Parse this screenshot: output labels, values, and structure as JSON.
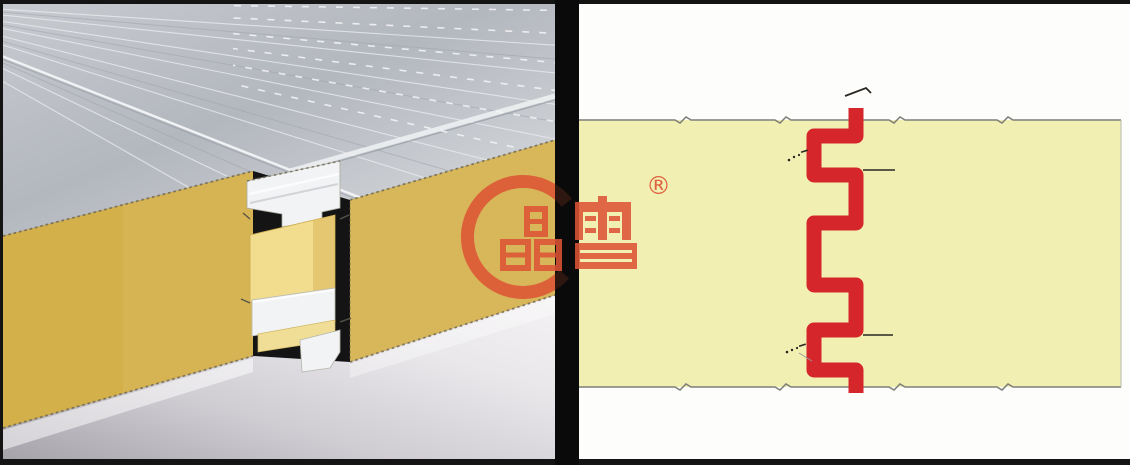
{
  "frame": {
    "border_color": "#141414"
  },
  "divider": {
    "color": "#0a0a0a"
  },
  "photo": {
    "alt": "3D rendering of two insulated sandwich panels locked together: grey ribbed metal roof facing on top, yellow foam core cross-section facing the viewer, white metal tongue-and-groove interlock at the centre joint",
    "colors": {
      "roof_metal": "#c2c6cb",
      "core_yellow": "#d4b04a",
      "joint_foam": "#f2dc8e",
      "joint_metal": "#f2f3f5",
      "floor": "#d8d6db"
    }
  },
  "brand": {
    "logo_text": "晶雪",
    "registered_mark": "®",
    "logo_color": "#dd5435"
  },
  "diagram": {
    "alt": "Cross-section diagram of the panel joint: pale yellow core band with a red interlocking seam profile, leader lines and edge break marks",
    "panel_fill": "#f2efb2",
    "panel_edge_color": "#7e7e78",
    "seam_color": "#d5262b",
    "annotation_color": "#2a2622",
    "background": "#fdfdfc"
  }
}
